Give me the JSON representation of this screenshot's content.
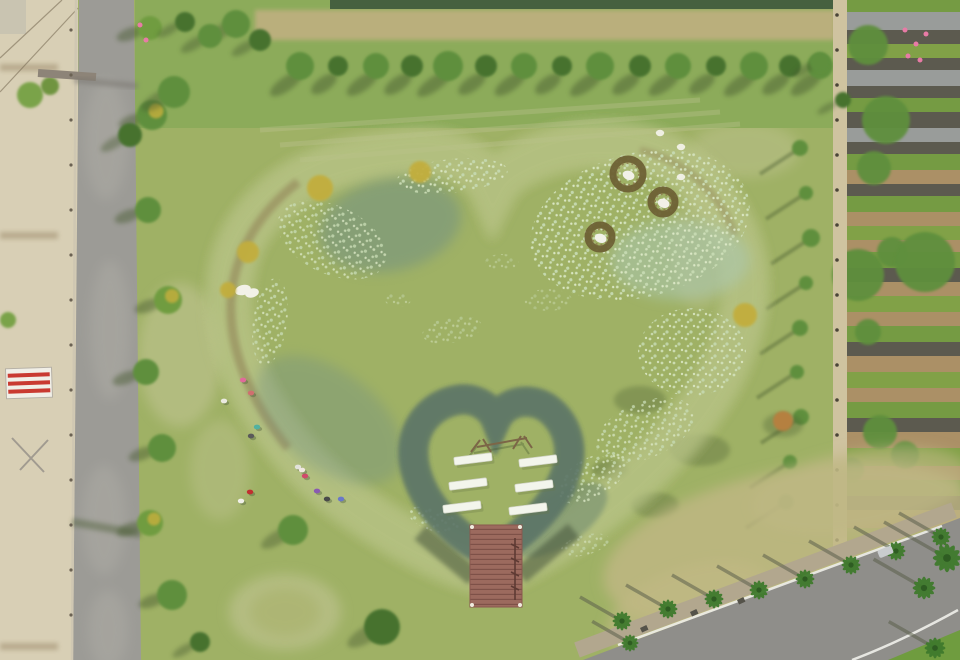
{
  "scene": {
    "description": "Aerial drone photograph of a heart-shaped pond in a park: a smaller heart-shaped grass island with six white benches and a red wooden dock sits inside the pond; visitors rest on the south-west bank; a tree-lined country road runs along the left, farm plots on the right, and a palm-lined road crosses the lower-right corner.",
    "pond_shape": "heart",
    "island_bench_count": 6,
    "floating_nest_count": 3,
    "visitor_count": 13
  },
  "colors": {
    "grassBase": "#9fb165",
    "grassLight": "#c6c79a",
    "grassDark": "#7f9c4f",
    "topBand": "#8cab5a",
    "canal": "#46603f",
    "dirt": "#c3b083",
    "treeGreen": "#5e8f3c",
    "treeDark": "#47722f",
    "treeYellow": "#c2ae3e",
    "treeOrange": "#b5803f",
    "waterDarkPatch": "#6e8e85",
    "ringOlive": "#6a6c3e",
    "ringGreen": "#85a84e",
    "halo": "#b9c488",
    "reed": "#907f55",
    "islandGrass": "#a2b56e",
    "islandLight": "#bcc883",
    "deckRed": "#9c6a5e",
    "deckLine": "#7e5148",
    "benchWhite": "#f3f5ec",
    "roadGray": "#9c9b96",
    "roadLight": "#b6b4ac",
    "sand": "#d8cfb5",
    "sandRow": "#b3a587",
    "pathTan": "#cfc3a0",
    "agSoil": "#ab9066",
    "palmGreen": "#3f7a2d",
    "palmDark": "#2e5c22",
    "shadow": "#45592f",
    "nestBrown": "#6e6135",
    "lilyPale": "#d4e3bd",
    "birdWhite": "#f2f1e8",
    "signRed": "#c93a31",
    "signWhite": "#f1efe7",
    "flowerPink": "#e87ba6",
    "laneWhite": "#efefea",
    "sidewalk": "#b2a78e",
    "dryGrass": "#c0b884",
    "carGray": "#c9ccce",
    "frameBrown": "#7c6647",
    "waterLow": "#7fa092",
    "waterMid": "#8fae9f",
    "waterHigh": "#abc9b7"
  },
  "topTrees": [
    {
      "x": 300,
      "r": 14
    },
    {
      "x": 338,
      "r": 10
    },
    {
      "x": 376,
      "r": 13
    },
    {
      "x": 412,
      "r": 11
    },
    {
      "x": 448,
      "r": 15
    },
    {
      "x": 486,
      "r": 11
    },
    {
      "x": 524,
      "r": 13
    },
    {
      "x": 562,
      "r": 10
    },
    {
      "x": 600,
      "r": 14
    },
    {
      "x": 640,
      "r": 11
    },
    {
      "x": 678,
      "r": 13
    },
    {
      "x": 716,
      "r": 10
    },
    {
      "x": 754,
      "r": 14
    },
    {
      "x": 790,
      "r": 11
    },
    {
      "x": 820,
      "r": 13
    }
  ],
  "roadBushes": [
    {
      "x": 150,
      "y": 28,
      "r": 12,
      "yellow": false
    },
    {
      "x": 152,
      "y": 115,
      "r": 15,
      "yellow": true
    },
    {
      "x": 148,
      "y": 210,
      "r": 13,
      "yellow": false
    },
    {
      "x": 168,
      "y": 300,
      "r": 14,
      "yellow": true
    },
    {
      "x": 146,
      "y": 372,
      "r": 13,
      "yellow": false
    },
    {
      "x": 162,
      "y": 448,
      "r": 14,
      "yellow": false
    },
    {
      "x": 150,
      "y": 523,
      "r": 13,
      "yellow": true
    },
    {
      "x": 172,
      "y": 595,
      "r": 15,
      "yellow": false
    }
  ],
  "rightTrees": [
    {
      "x": 800,
      "y": 148,
      "r": 8
    },
    {
      "x": 806,
      "y": 193,
      "r": 7
    },
    {
      "x": 811,
      "y": 238,
      "r": 9
    },
    {
      "x": 806,
      "y": 283,
      "r": 7
    },
    {
      "x": 800,
      "y": 328,
      "r": 8
    },
    {
      "x": 797,
      "y": 372,
      "r": 7
    },
    {
      "x": 801,
      "y": 417,
      "r": 8
    },
    {
      "x": 790,
      "y": 462,
      "r": 7
    },
    {
      "x": 786,
      "y": 502,
      "r": 8
    }
  ],
  "agStripes": [
    [
      0,
      12,
      "#6f9c3f"
    ],
    [
      12,
      18,
      "#979da0"
    ],
    [
      30,
      14,
      "#53544d"
    ],
    [
      44,
      14,
      "#7ca344"
    ],
    [
      58,
      12,
      "#53544d"
    ],
    [
      70,
      16,
      "#979da0"
    ],
    [
      86,
      12,
      "#53544d"
    ],
    [
      98,
      14,
      "#6f9c3f"
    ],
    [
      112,
      16,
      "#53544d"
    ],
    [
      128,
      14,
      "#979da0"
    ],
    [
      142,
      12,
      "#53544d"
    ],
    [
      154,
      16,
      "#6f9c3f"
    ],
    [
      170,
      14,
      "#ab9066"
    ],
    [
      184,
      12,
      "#53544d"
    ],
    [
      196,
      16,
      "#6f9c3f"
    ],
    [
      212,
      14,
      "#ab9066"
    ],
    [
      226,
      14,
      "#7ca344"
    ],
    [
      240,
      12,
      "#ab9066"
    ],
    [
      252,
      16,
      "#6f9c3f"
    ],
    [
      268,
      14,
      "#53544d"
    ],
    [
      282,
      14,
      "#ab9066"
    ],
    [
      296,
      16,
      "#7ca344"
    ],
    [
      312,
      14,
      "#ab9066"
    ],
    [
      326,
      16,
      "#6f9c3f"
    ],
    [
      342,
      14,
      "#53544d"
    ],
    [
      356,
      16,
      "#ab9066"
    ],
    [
      372,
      16,
      "#7ca344"
    ],
    [
      388,
      14,
      "#ab9066"
    ],
    [
      402,
      16,
      "#6f9c3f"
    ],
    [
      418,
      14,
      "#53544d"
    ],
    [
      432,
      16,
      "#ab9066"
    ],
    [
      448,
      18,
      "#7ca344"
    ],
    [
      466,
      14,
      "#ab9066"
    ],
    [
      480,
      16,
      "#6f9c3f"
    ],
    [
      496,
      14,
      "#53544d"
    ],
    [
      510,
      18,
      "#ab9066"
    ],
    [
      528,
      17,
      "#7ca344"
    ]
  ],
  "agTrees": [
    {
      "x": 868,
      "y": 45,
      "r": 20
    },
    {
      "x": 886,
      "y": 120,
      "r": 24
    },
    {
      "x": 874,
      "y": 168,
      "r": 17
    },
    {
      "x": 858,
      "y": 275,
      "r": 26
    },
    {
      "x": 892,
      "y": 252,
      "r": 15
    },
    {
      "x": 925,
      "y": 262,
      "r": 30
    },
    {
      "x": 868,
      "y": 332,
      "r": 13
    },
    {
      "x": 880,
      "y": 432,
      "r": 17
    },
    {
      "x": 852,
      "y": 470,
      "r": 12
    },
    {
      "x": 905,
      "y": 455,
      "r": 14
    }
  ],
  "flowers": [
    {
      "x": 905,
      "y": 30
    },
    {
      "x": 916,
      "y": 44
    },
    {
      "x": 926,
      "y": 34
    },
    {
      "x": 908,
      "y": 56
    },
    {
      "x": 920,
      "y": 60
    },
    {
      "x": 140,
      "y": 25
    },
    {
      "x": 146,
      "y": 40
    }
  ],
  "palms": [
    {
      "x": 622,
      "y": 621,
      "s": 1
    },
    {
      "x": 668,
      "y": 609,
      "s": 1
    },
    {
      "x": 714,
      "y": 599,
      "s": 1
    },
    {
      "x": 759,
      "y": 590,
      "s": 1
    },
    {
      "x": 805,
      "y": 579,
      "s": 1
    },
    {
      "x": 851,
      "y": 565,
      "s": 1
    },
    {
      "x": 896,
      "y": 551,
      "s": 1
    },
    {
      "x": 941,
      "y": 537,
      "s": 1
    },
    {
      "x": 947,
      "y": 558,
      "s": 1.5
    },
    {
      "x": 924,
      "y": 588,
      "s": 1.2
    },
    {
      "x": 935,
      "y": 648,
      "s": 1.1
    },
    {
      "x": 630,
      "y": 643,
      "s": 0.9
    }
  ],
  "bins": [
    {
      "x": 640,
      "y": 628
    },
    {
      "x": 690,
      "y": 612
    },
    {
      "x": 737,
      "y": 600
    }
  ],
  "people": [
    {
      "x": 243,
      "y": 380,
      "c": "#e06a9a"
    },
    {
      "x": 251,
      "y": 393,
      "c": "#cf6f6f"
    },
    {
      "x": 224,
      "y": 401,
      "c": "#eaeae0"
    },
    {
      "x": 257,
      "y": 427,
      "c": "#52b1a1"
    },
    {
      "x": 251,
      "y": 436,
      "c": "#5a5a5a"
    },
    {
      "x": 298,
      "y": 467,
      "c": "#e2e2da"
    },
    {
      "x": 305,
      "y": 476,
      "c": "#d04a6a"
    },
    {
      "x": 250,
      "y": 492,
      "c": "#c03030"
    },
    {
      "x": 241,
      "y": 501,
      "c": "#f0f0e8"
    },
    {
      "x": 317,
      "y": 491,
      "c": "#8a5ab0"
    },
    {
      "x": 327,
      "y": 499,
      "c": "#4a4a4a"
    },
    {
      "x": 341,
      "y": 499,
      "c": "#6a78c8"
    },
    {
      "x": 302,
      "y": 470,
      "c": "#f0e8e0"
    }
  ],
  "nests": [
    {
      "x": 628,
      "y": 174,
      "r": 15
    },
    {
      "x": 663,
      "y": 202,
      "r": 12
    },
    {
      "x": 600,
      "y": 237,
      "r": 12
    }
  ],
  "birds": [
    {
      "x": 660,
      "y": 133
    },
    {
      "x": 681,
      "y": 147
    },
    {
      "x": 681,
      "y": 177
    }
  ],
  "lilies": [
    {
      "x": 640,
      "y": 225,
      "rx": 112,
      "ry": 72,
      "rot": -15,
      "o": 0.95
    },
    {
      "x": 452,
      "y": 176,
      "rx": 56,
      "ry": 17,
      "rot": -6,
      "o": 0.9
    },
    {
      "x": 332,
      "y": 240,
      "rx": 58,
      "ry": 34,
      "rot": 25,
      "o": 0.8
    },
    {
      "x": 270,
      "y": 322,
      "rx": 17,
      "ry": 44,
      "rot": 8,
      "o": 0.8
    },
    {
      "x": 452,
      "y": 330,
      "rx": 30,
      "ry": 13,
      "rot": -10,
      "o": 0.5
    },
    {
      "x": 548,
      "y": 300,
      "rx": 24,
      "ry": 11,
      "rot": 0,
      "o": 0.4
    },
    {
      "x": 692,
      "y": 352,
      "rx": 54,
      "ry": 44,
      "rot": 0,
      "o": 0.85
    },
    {
      "x": 645,
      "y": 430,
      "rx": 52,
      "ry": 28,
      "rot": -22,
      "o": 0.8
    },
    {
      "x": 592,
      "y": 478,
      "rx": 38,
      "ry": 20,
      "rot": -30,
      "o": 0.8
    },
    {
      "x": 434,
      "y": 520,
      "rx": 27,
      "ry": 11,
      "rot": 18,
      "o": 0.8
    },
    {
      "x": 502,
      "y": 262,
      "rx": 17,
      "ry": 8,
      "rot": 0,
      "o": 0.4
    },
    {
      "x": 398,
      "y": 300,
      "rx": 13,
      "ry": 7,
      "rot": 0,
      "o": 0.45
    },
    {
      "x": 585,
      "y": 545,
      "rx": 25,
      "ry": 10,
      "rot": -15,
      "o": 0.6
    }
  ],
  "yellowTrees": [
    {
      "x": 320,
      "y": 188,
      "r": 13
    },
    {
      "x": 420,
      "y": 172,
      "r": 11
    },
    {
      "x": 248,
      "y": 252,
      "r": 11
    },
    {
      "x": 745,
      "y": 315,
      "r": 12
    },
    {
      "x": 228,
      "y": 290,
      "r": 8
    }
  ],
  "benches": [
    {
      "x": 473,
      "y": 459
    },
    {
      "x": 468,
      "y": 484
    },
    {
      "x": 462,
      "y": 507
    },
    {
      "x": 538,
      "y": 461
    },
    {
      "x": 534,
      "y": 486
    },
    {
      "x": 528,
      "y": 509
    }
  ],
  "fieldTrees": [
    {
      "x": 382,
      "y": 627,
      "r": 18
    },
    {
      "x": 293,
      "y": 530,
      "r": 15
    },
    {
      "x": 200,
      "y": 642,
      "r": 10
    },
    {
      "x": 174,
      "y": 92,
      "r": 16
    },
    {
      "x": 130,
      "y": 135,
      "r": 12
    },
    {
      "x": 820,
      "y": 62,
      "r": 10
    },
    {
      "x": 843,
      "y": 100,
      "r": 8
    },
    {
      "x": 236,
      "y": 24,
      "r": 14
    },
    {
      "x": 260,
      "y": 40,
      "r": 11
    },
    {
      "x": 210,
      "y": 36,
      "r": 12
    },
    {
      "x": 185,
      "y": 22,
      "r": 10
    }
  ],
  "shadowBlobs": [
    {
      "x": 640,
      "y": 400,
      "rx": 26,
      "ry": 14
    },
    {
      "x": 700,
      "y": 450,
      "rx": 30,
      "ry": 16
    },
    {
      "x": 655,
      "y": 505,
      "rx": 24,
      "ry": 13
    },
    {
      "x": 610,
      "y": 470,
      "rx": 18,
      "ry": 10
    },
    {
      "x": 783,
      "y": 425,
      "rx": 20,
      "ry": 12
    }
  ],
  "lightPatches": [
    {
      "x": 180,
      "y": 355,
      "rx": 42,
      "ry": 72,
      "o": 0.5
    },
    {
      "x": 285,
      "y": 612,
      "rx": 56,
      "ry": 38,
      "o": 0.55
    },
    {
      "x": 620,
      "y": 95,
      "rx": 80,
      "ry": 24,
      "o": 0.35
    },
    {
      "x": 745,
      "y": 150,
      "rx": 55,
      "ry": 28,
      "o": 0.4
    },
    {
      "x": 220,
      "y": 470,
      "rx": 30,
      "ry": 50,
      "o": 0.35
    },
    {
      "x": 700,
      "y": 250,
      "rx": 30,
      "ry": 60,
      "o": 0.3
    }
  ],
  "sandRows": [
    64,
    232,
    643
  ]
}
